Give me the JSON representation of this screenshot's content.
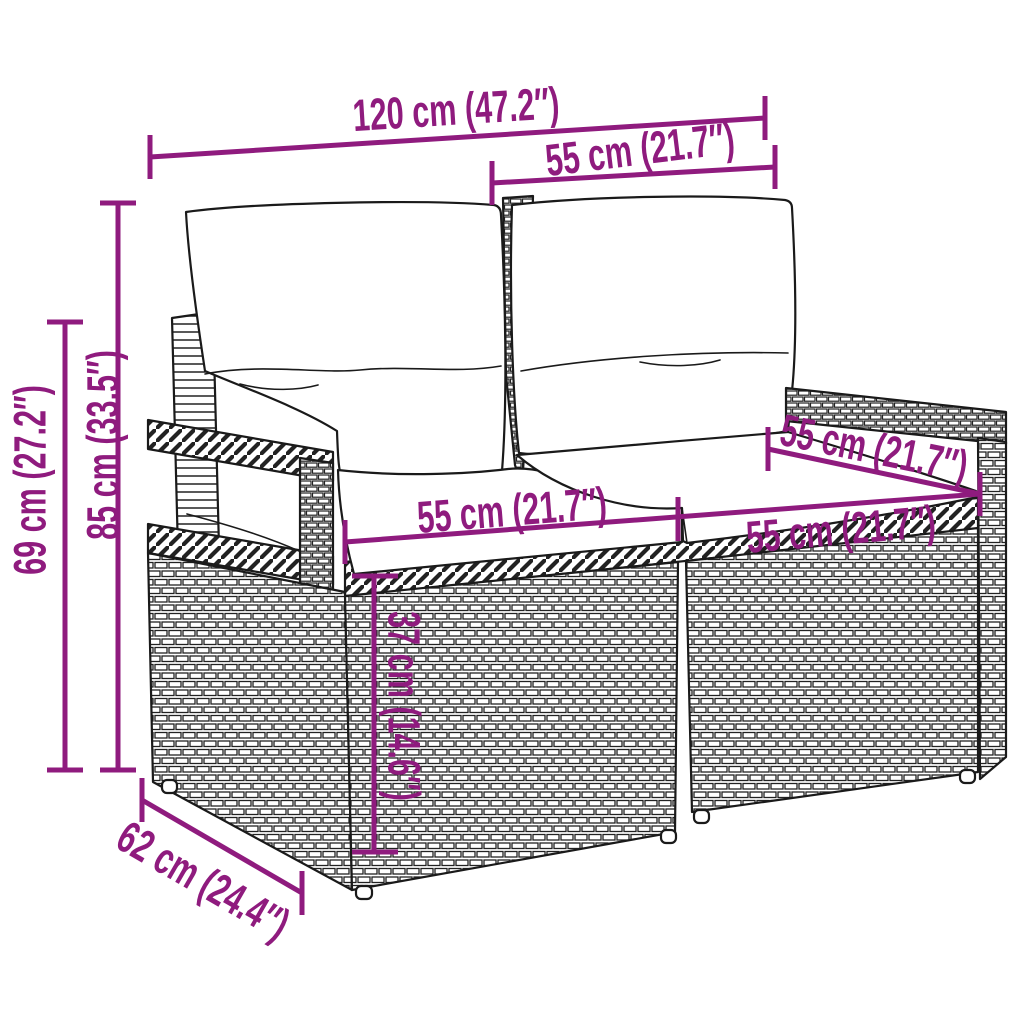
{
  "diagram": {
    "subject": "2-seater poly rattan garden sofa with back pillows and seat cushions",
    "accent_color": "#8F1B7E",
    "line_color": "#1A1A1A",
    "background_color": "#FFFFFF",
    "dimensions": {
      "overall_width": "120 cm (47.2″)",
      "backrest_width": "55 cm (21.7″)",
      "overall_height": "85 cm (33.5″)",
      "armrest_height": "69 cm (27.2″)",
      "seat_depth": "55 cm (21.7″)",
      "seat_width_left": "55 cm (21.7″)",
      "seat_width_right": "55 cm (21.7″)",
      "seat_height": "37 cm (14.6″)",
      "overall_depth": "62 cm (24.4″)"
    }
  }
}
